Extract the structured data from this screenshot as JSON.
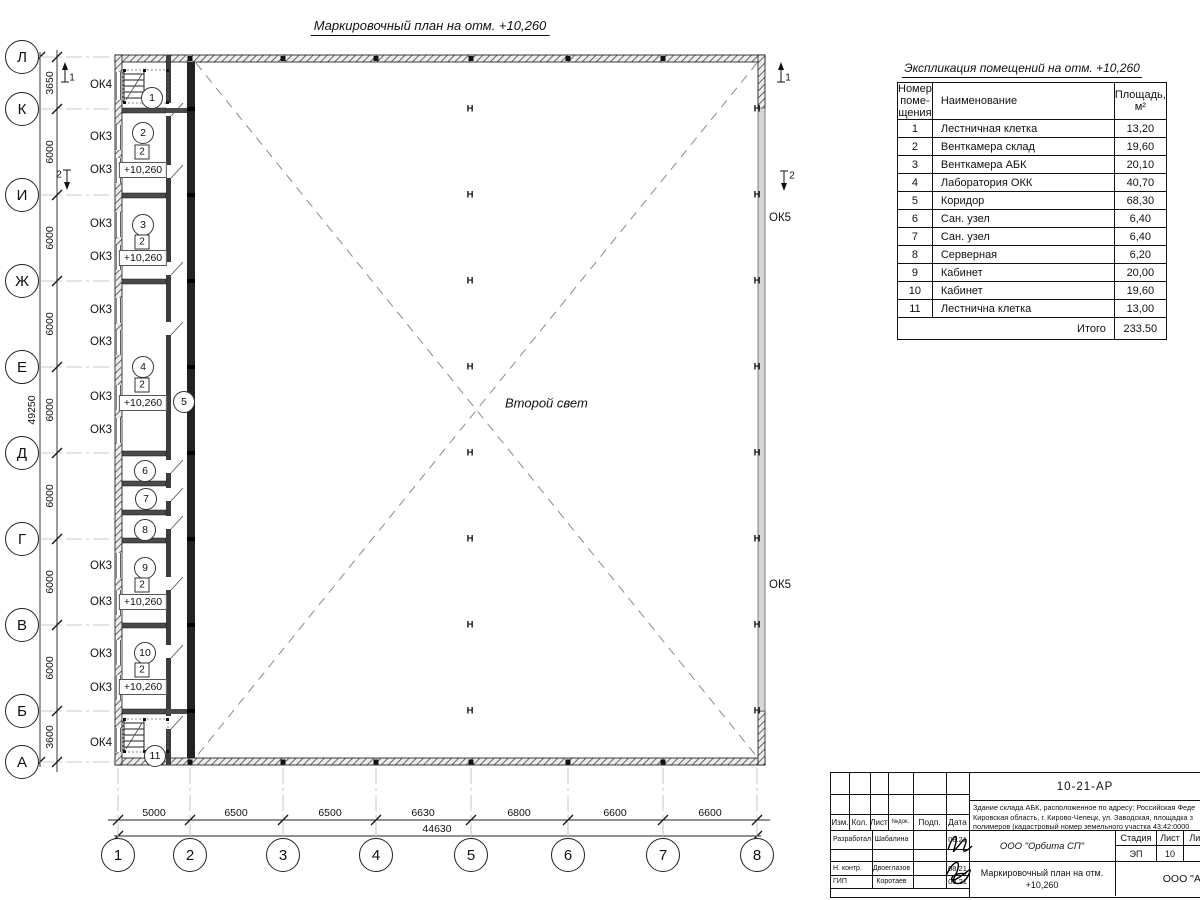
{
  "title": "Маркировочный план на отм. +10,260",
  "plan": {
    "center_label": "Второй свет",
    "column_symbol": "Н",
    "axis_rows": [
      {
        "label": "Л",
        "y": 57
      },
      {
        "label": "К",
        "y": 109
      },
      {
        "label": "И",
        "y": 195
      },
      {
        "label": "Ж",
        "y": 281
      },
      {
        "label": "Е",
        "y": 367
      },
      {
        "label": "Д",
        "y": 453
      },
      {
        "label": "Г",
        "y": 539
      },
      {
        "label": "В",
        "y": 625
      },
      {
        "label": "Б",
        "y": 711
      },
      {
        "label": "А",
        "y": 762
      }
    ],
    "axis_cols": [
      {
        "label": "1",
        "x": 118
      },
      {
        "label": "2",
        "x": 190
      },
      {
        "label": "3",
        "x": 283
      },
      {
        "label": "4",
        "x": 376
      },
      {
        "label": "5",
        "x": 471
      },
      {
        "label": "6",
        "x": 568
      },
      {
        "label": "7",
        "x": 663
      },
      {
        "label": "8",
        "x": 757
      }
    ],
    "left_dims": {
      "total": "49250",
      "segments": [
        {
          "label": "3650",
          "y": 83
        },
        {
          "label": "6000",
          "y": 152
        },
        {
          "label": "6000",
          "y": 238
        },
        {
          "label": "6000",
          "y": 324
        },
        {
          "label": "6000",
          "y": 410
        },
        {
          "label": "6000",
          "y": 496
        },
        {
          "label": "6000",
          "y": 582
        },
        {
          "label": "6000",
          "y": 668
        },
        {
          "label": "3600",
          "y": 737
        }
      ]
    },
    "bottom_dims": {
      "total": "44630",
      "segments": [
        {
          "label": "5000",
          "x": 154
        },
        {
          "label": "6500",
          "x": 236
        },
        {
          "label": "6500",
          "x": 330
        },
        {
          "label": "6630",
          "x": 423
        },
        {
          "label": "6800",
          "x": 519
        },
        {
          "label": "6600",
          "x": 615
        },
        {
          "label": "6600",
          "x": 710
        }
      ]
    },
    "window_labels": [
      {
        "text": "ОК4",
        "x": 112,
        "y": 85,
        "anchor": "right"
      },
      {
        "text": "ОК3",
        "x": 112,
        "y": 137,
        "anchor": "right"
      },
      {
        "text": "ОК3",
        "x": 112,
        "y": 170,
        "anchor": "right"
      },
      {
        "text": "ОК3",
        "x": 112,
        "y": 224,
        "anchor": "right"
      },
      {
        "text": "ОК3",
        "x": 112,
        "y": 257,
        "anchor": "right"
      },
      {
        "text": "ОК3",
        "x": 112,
        "y": 310,
        "anchor": "right"
      },
      {
        "text": "ОК3",
        "x": 112,
        "y": 342,
        "anchor": "right"
      },
      {
        "text": "ОК3",
        "x": 112,
        "y": 397,
        "anchor": "right"
      },
      {
        "text": "ОК3",
        "x": 112,
        "y": 430,
        "anchor": "right"
      },
      {
        "text": "ОК3",
        "x": 112,
        "y": 566,
        "anchor": "right"
      },
      {
        "text": "ОК3",
        "x": 112,
        "y": 602,
        "anchor": "right"
      },
      {
        "text": "ОК3",
        "x": 112,
        "y": 654,
        "anchor": "right"
      },
      {
        "text": "ОК3",
        "x": 112,
        "y": 688,
        "anchor": "right"
      },
      {
        "text": "ОК4",
        "x": 112,
        "y": 743,
        "anchor": "right"
      },
      {
        "text": "ОК5",
        "x": 769,
        "y": 218,
        "anchor": "left"
      },
      {
        "text": "ОК5",
        "x": 769,
        "y": 585,
        "anchor": "left"
      }
    ],
    "room_markers": [
      {
        "num": "1",
        "x": 152,
        "y": 98
      },
      {
        "num": "2",
        "x": 143,
        "y": 133
      },
      {
        "num": "3",
        "x": 143,
        "y": 225
      },
      {
        "num": "4",
        "x": 143,
        "y": 367
      },
      {
        "num": "5",
        "x": 184,
        "y": 402
      },
      {
        "num": "6",
        "x": 145,
        "y": 471
      },
      {
        "num": "7",
        "x": 146,
        "y": 499
      },
      {
        "num": "8",
        "x": 145,
        "y": 530
      },
      {
        "num": "9",
        "x": 145,
        "y": 568
      },
      {
        "num": "10",
        "x": 145,
        "y": 653
      },
      {
        "num": "11",
        "x": 155,
        "y": 756
      }
    ],
    "unit_squares": [
      {
        "text": "2",
        "x": 142,
        "y": 152
      },
      {
        "text": "2",
        "x": 142,
        "y": 242
      },
      {
        "text": "2",
        "x": 142,
        "y": 385
      },
      {
        "text": "2",
        "x": 142,
        "y": 585
      },
      {
        "text": "2",
        "x": 142,
        "y": 670
      }
    ],
    "elevations": [
      {
        "text": "+10,260",
        "x": 143,
        "y": 170
      },
      {
        "text": "+10,260",
        "x": 143,
        "y": 258
      },
      {
        "text": "+10,260",
        "x": 143,
        "y": 403
      },
      {
        "text": "+10,260",
        "x": 143,
        "y": 602
      },
      {
        "text": "+10,260",
        "x": 143,
        "y": 687
      }
    ],
    "h_columns": [
      {
        "x": 470,
        "y": 109
      },
      {
        "x": 470,
        "y": 195
      },
      {
        "x": 470,
        "y": 281
      },
      {
        "x": 470,
        "y": 367
      },
      {
        "x": 470,
        "y": 453
      },
      {
        "x": 470,
        "y": 539
      },
      {
        "x": 470,
        "y": 625
      },
      {
        "x": 470,
        "y": 711
      },
      {
        "x": 757,
        "y": 109
      },
      {
        "x": 757,
        "y": 195
      },
      {
        "x": 757,
        "y": 281
      },
      {
        "x": 757,
        "y": 367
      },
      {
        "x": 757,
        "y": 453
      },
      {
        "x": 757,
        "y": 539
      },
      {
        "x": 757,
        "y": 625
      },
      {
        "x": 757,
        "y": 711
      }
    ],
    "section_marks": [
      {
        "label": "1",
        "dir": "up",
        "ax": 65,
        "ay": 72,
        "lx": 72,
        "ly": 78
      },
      {
        "label": "2",
        "dir": "down",
        "ax": 67,
        "ay": 180,
        "lx": 59,
        "ly": 175
      },
      {
        "label": "1",
        "dir": "up",
        "ax": 781,
        "ay": 72,
        "lx": 788,
        "ly": 78
      },
      {
        "label": "2",
        "dir": "down",
        "ax": 784,
        "ay": 181,
        "lx": 792,
        "ly": 176
      }
    ]
  },
  "schedule": {
    "title": "Экспликация помещений на отм. +10,260",
    "headers": [
      "Номер\nпоме-\nщения",
      "Наименование",
      "Площадь,\nм²"
    ],
    "rows": [
      [
        "1",
        "Лестничная клетка",
        "13,20"
      ],
      [
        "2",
        "Венткамера склад",
        "19,60"
      ],
      [
        "3",
        "Венткамера АБК",
        "20,10"
      ],
      [
        "4",
        "Лаборатория ОКК",
        "40,70"
      ],
      [
        "5",
        "Коридор",
        "68,30"
      ],
      [
        "6",
        "Сан. узел",
        "6,40"
      ],
      [
        "7",
        "Сан. узел",
        "6,40"
      ],
      [
        "8",
        "Серверная",
        "6,20"
      ],
      [
        "9",
        "Кабинет",
        "20,00"
      ],
      [
        "10",
        "Кабинет",
        "19,60"
      ],
      [
        "11",
        "Лестнична клетка",
        "13,00"
      ]
    ],
    "total_label": "Итого",
    "total_value": "233.50"
  },
  "title_block": {
    "doc_code": "10-21-АР",
    "description_lines": [
      "Здание склада АБК, расположенное по адресу: Российская Феде",
      "Кировская область, г. Кирово-Чепецк, ул. Заводская, площадка з",
      "полимеров (кадастровый номер земельного участка 43:42:0000"
    ],
    "columns": [
      "Изм.",
      "Кол.",
      "Лист",
      "№док.",
      "Подп.",
      "Дата"
    ],
    "roles": [
      {
        "role": "Разработал",
        "name": "Шабалина",
        "date": "08.21"
      },
      {
        "role": "",
        "name": "",
        "date": ""
      },
      {
        "role": "Н. контр.",
        "name": "Двоеглазов",
        "date": "08.21"
      },
      {
        "role": "ГИП",
        "name": "Коротаев",
        "date": "08.21"
      }
    ],
    "org": "ООО \"Орбита СП\"",
    "stage_label": "Стадия",
    "sheet_label": "Лист",
    "sheets_label": "Листов",
    "stage": "ЭП",
    "sheet": "10",
    "sheets": "1",
    "drawing_title": "Маркировочный план на отм.\n+10,260",
    "company": "ООО \"Альянс"
  }
}
